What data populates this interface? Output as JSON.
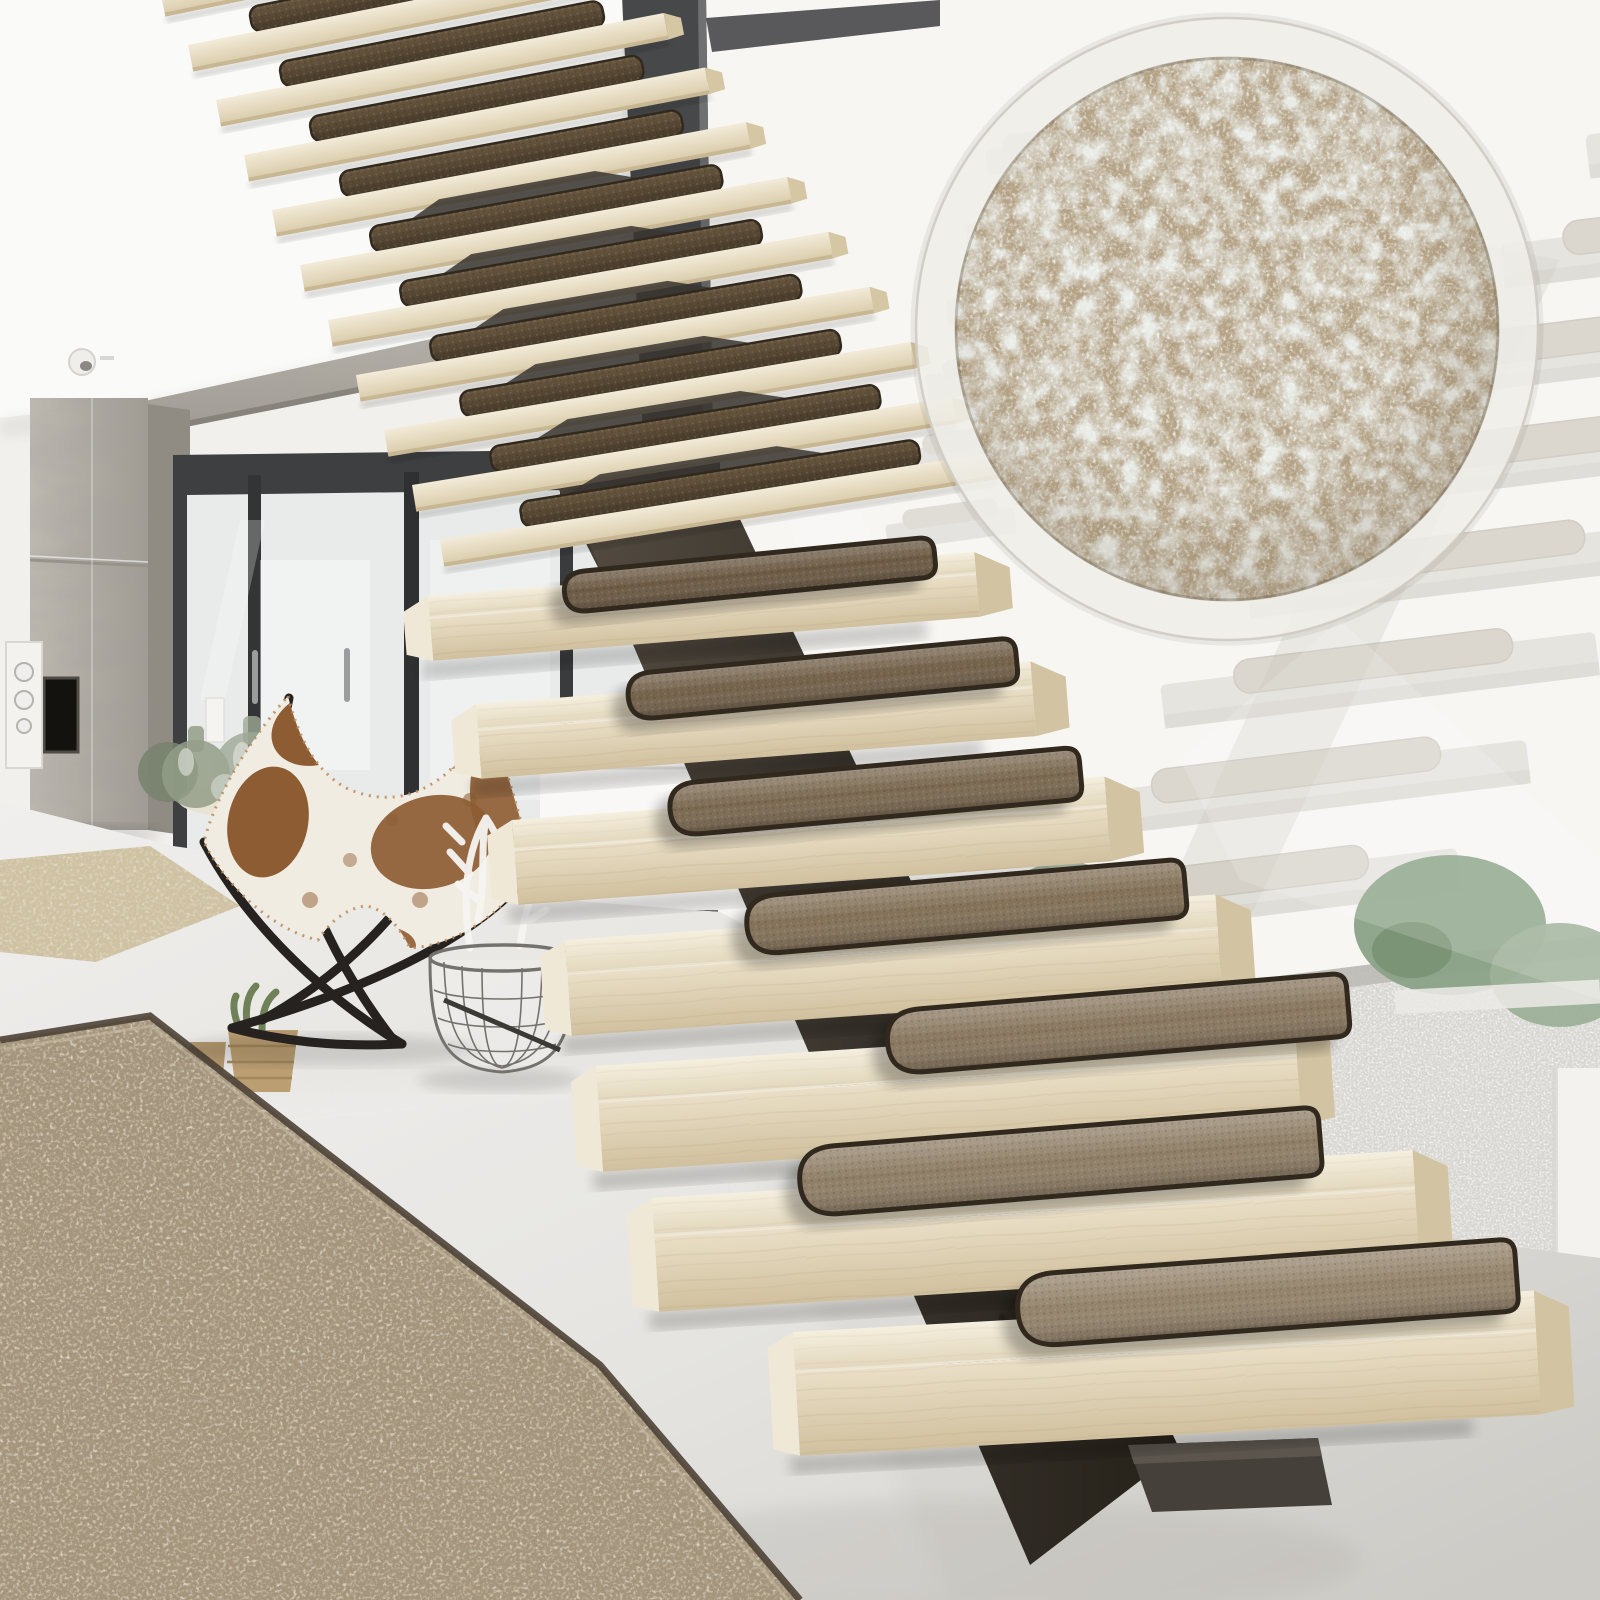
{
  "scene": {
    "subject": "floating-wood-staircase-with-carpet-stair-tread-mats",
    "setting": "modern-concrete-loft-interior",
    "inset": {
      "shape": "circle",
      "content": "carpet-texture-closeup"
    },
    "counts": {
      "lower_steps": 7,
      "upper_edge_steps": 12,
      "ghost_steps": 8,
      "stair_mats_visible": 19
    },
    "palette": {
      "wall": "#f2f0ed",
      "wall_right": "#f7f6f3",
      "ceiling": "#fafaf8",
      "concrete": "#b3afa7",
      "concrete_side": "#908c84",
      "window_frame": "#47484a",
      "glass": "#e8ebea",
      "wood_top": "#f1eadb",
      "wood_front": "#e0d4b8",
      "wood_side": "#d2c3a2",
      "wood_end": "#efe8d6",
      "mat_border": "#32291e",
      "mat_shades": [
        "#94836b",
        "#8f7e66",
        "#89775f",
        "#837158",
        "#7b6951",
        "#73614a",
        "#6c5a44"
      ],
      "mat_upper_hi": "#6b5941",
      "mat_upper_lo": "#4a3c2d",
      "steel": "#463f37",
      "steel_dark": "#2c2721",
      "floor_near": "#d0cec9",
      "floor_far": "#efeeec",
      "rug": "#a4947b",
      "rug_trim": "#4e4336",
      "rug_small": "#cfc2a3",
      "inset_base": "#b4a286",
      "ring": "#efede8",
      "cowhide": "#f1ece1",
      "cowhide_patch": "#8d5c33",
      "chair_frame": "#262220",
      "greenery": "#9aa794",
      "gravel": "#d7d5d0",
      "ghost_slab": "#d9d6d0",
      "ghost_mat": "#c5bfb2",
      "bottle_glass": "#939e87"
    }
  }
}
